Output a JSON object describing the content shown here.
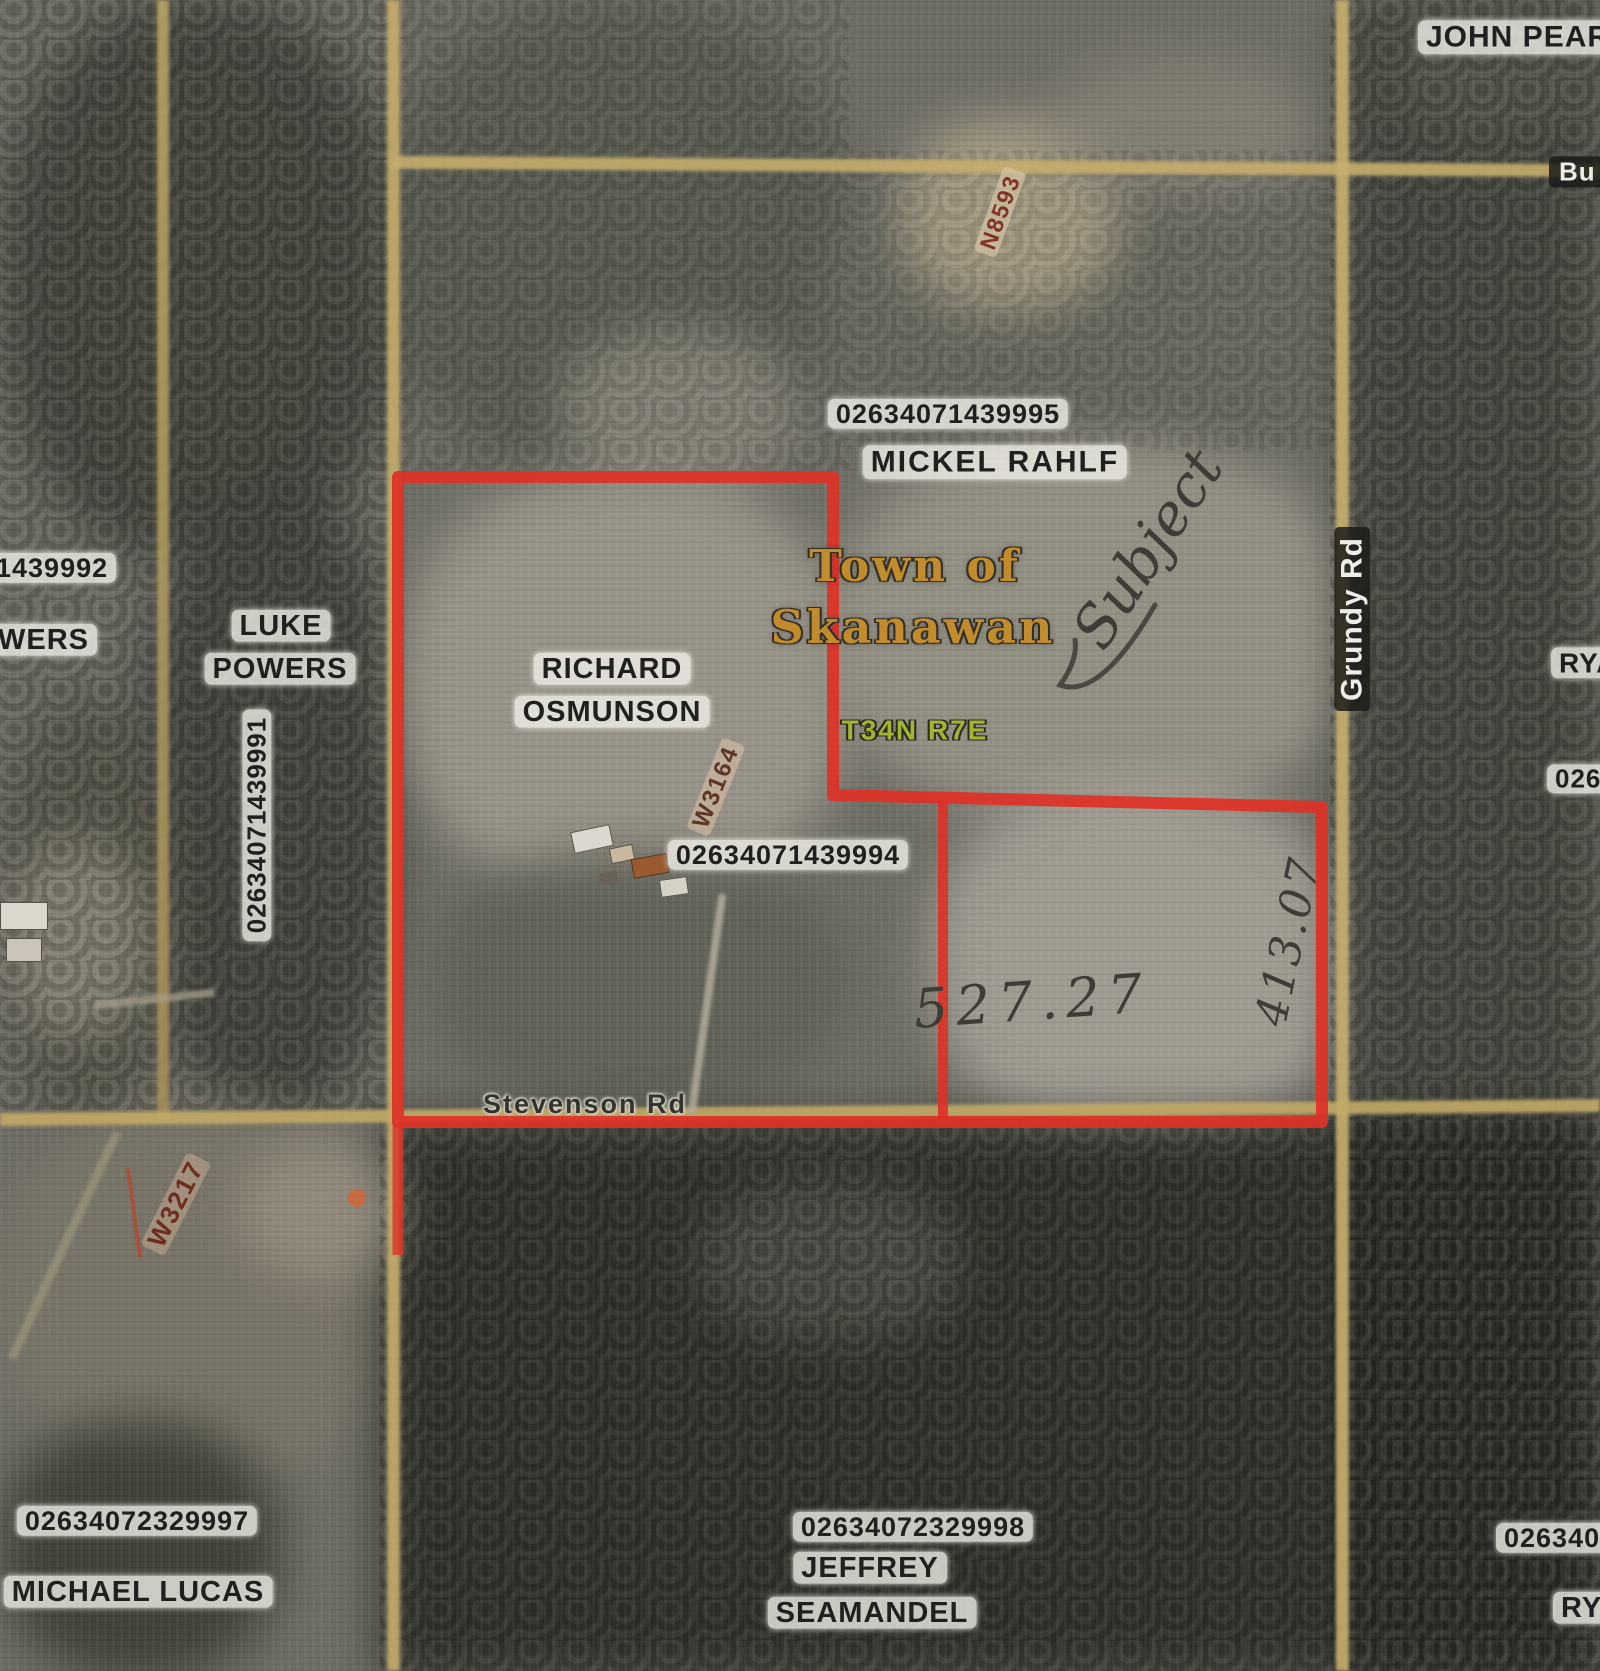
{
  "labels": {
    "john_pear_partial": "JOHN PEAR",
    "bu_partial": "Bu",
    "marker_n8593": "N8593",
    "parcel_rahlf_number": "02634071439995",
    "owner_rahlf": "MICKEL RAHLF",
    "town_line1": "Town of",
    "town_line2": "Skanawan",
    "township": "T34N R7E",
    "subject_note": "Subject",
    "road_grundy": "Grundy Rd",
    "owner_ryan_right_partial": "RYA",
    "parcel_right_partial": "026",
    "parcel_powers_partial": "1439992",
    "owner_powers_partial": "WERS",
    "owner_luke_line1": "LUKE",
    "owner_luke_line2": "POWERS",
    "parcel_osmunson_west": "02634071439991",
    "owner_osmunson_line1": "RICHARD",
    "owner_osmunson_line2": "OSMUNSON",
    "marker_w3164": "W3164",
    "parcel_osmunson_number": "02634071439994",
    "measure_south": "527.27",
    "measure_east": "413.07",
    "road_stevenson": "Stevenson Rd",
    "marker_w3217": "W3217",
    "parcel_lucas_number": "02634072329997",
    "owner_lucas": "MICHAEL LUCAS",
    "parcel_seamandel_number": "02634072329998",
    "owner_seamandel_line1": "JEFFREY",
    "owner_seamandel_line2": "SEAMANDEL",
    "parcel_bottom_right_partial": "026340",
    "owner_ryan_bottom_partial": "RYA"
  },
  "colors": {
    "subject_boundary_red": "#df3126",
    "road_tan": "#c6ae6c",
    "town_label_gold": "#c28c2c",
    "township_label_green": "#a3b431"
  }
}
